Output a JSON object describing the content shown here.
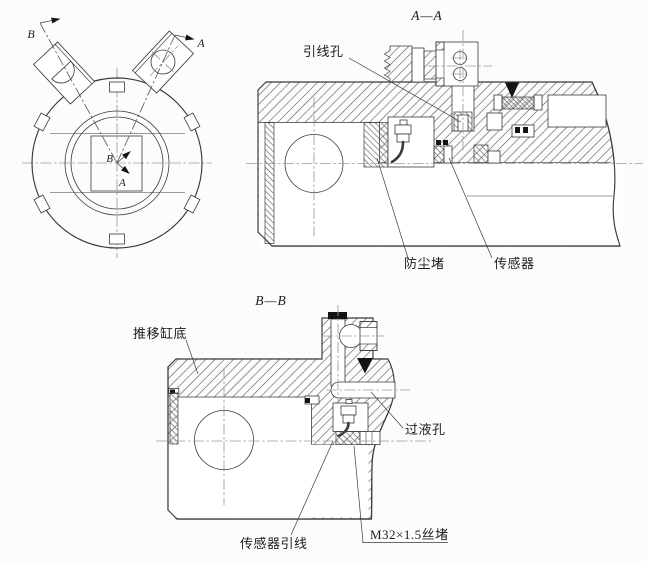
{
  "end_view": {
    "marker_b": "B",
    "marker_a": "A",
    "center_b": "B",
    "center_a": "A"
  },
  "aa": {
    "title": "A—A",
    "labels": {
      "lead_wire_hole": "引线孔",
      "dust_plug": "防尘堵",
      "sensor": "传感器"
    }
  },
  "bb": {
    "title": "B—B",
    "labels": {
      "cylinder_bottom": "推移缸底",
      "liquid_hole": "过液孔",
      "sensor_lead": "传感器引线",
      "screw_plug": "M32×1.5丝堵"
    }
  },
  "colors": {
    "line": "#3a3a3a",
    "centerline": "#9b9b9b",
    "hatch": "#5a5a5a",
    "background": "#fcfcfc"
  }
}
